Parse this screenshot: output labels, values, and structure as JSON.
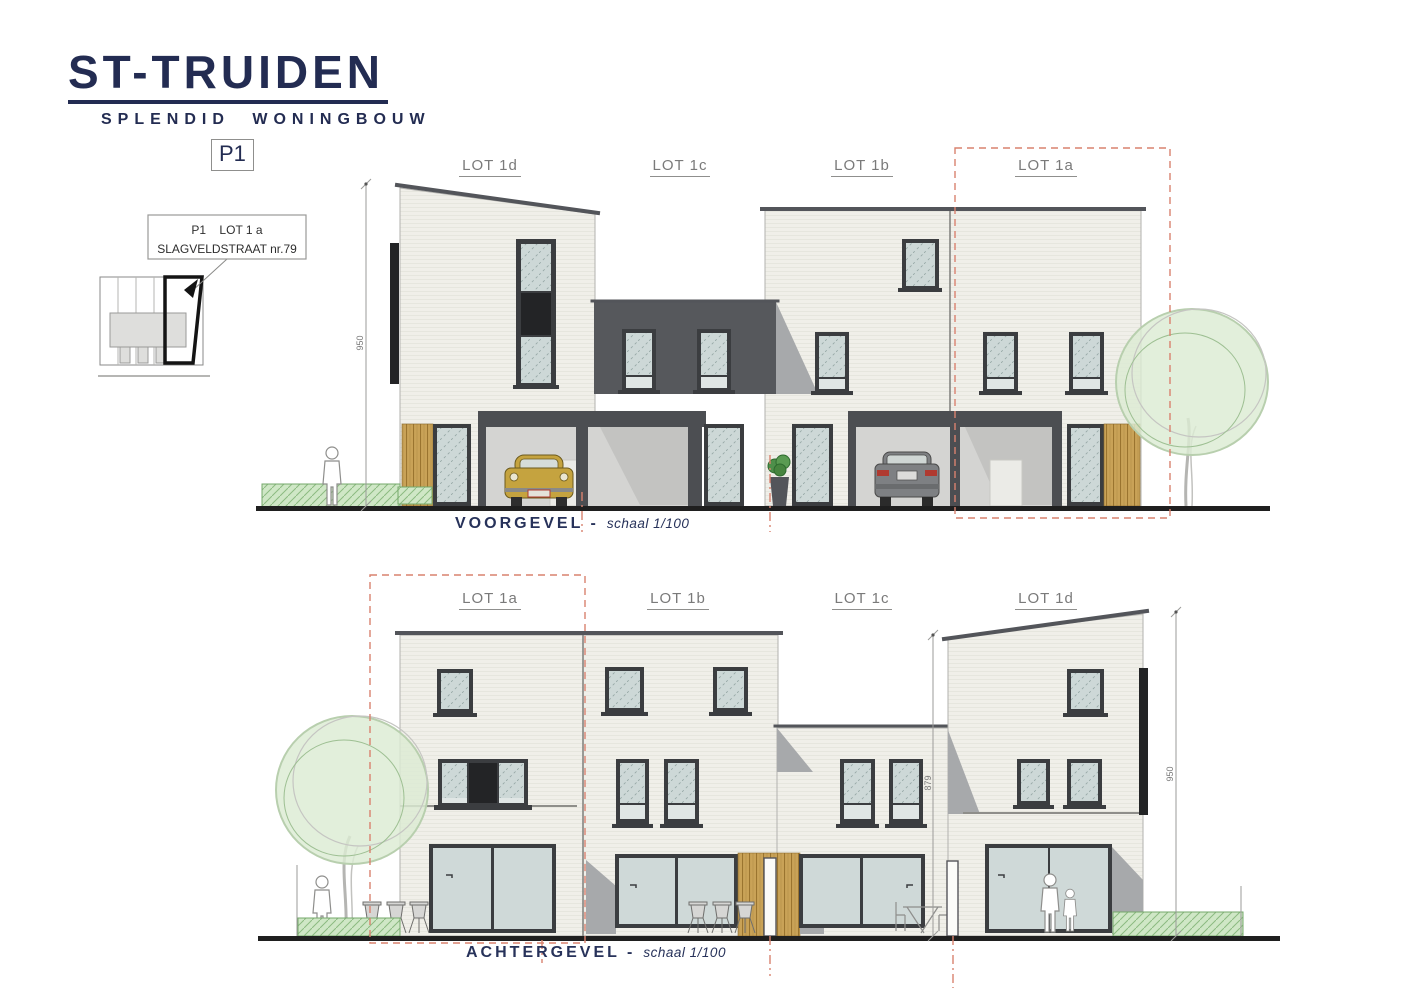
{
  "header": {
    "title": "ST-TRUIDEN",
    "subtitle": "SPLENDID WONINGBOUW",
    "sheet": "P1"
  },
  "site_plan": {
    "callout_line1": "P1    LOT 1 a",
    "callout_line2": "SLAGVELDSTRAAT nr.79"
  },
  "voorgevel": {
    "caption": "VOORGEVEL -",
    "scale": "schaal 1/100",
    "lots": [
      {
        "label": "LOT 1d"
      },
      {
        "label": "LOT 1c"
      },
      {
        "label": "LOT 1b"
      },
      {
        "label": "LOT 1a"
      }
    ],
    "dim_height": "950"
  },
  "achtergevel": {
    "caption": "ACHTERGEVEL -",
    "scale": "schaal 1/100",
    "lots": [
      {
        "label": "LOT 1a"
      },
      {
        "label": "LOT 1b"
      },
      {
        "label": "LOT 1c"
      },
      {
        "label": "LOT 1d"
      }
    ],
    "dim_mid": "879",
    "dim_right": "950"
  },
  "colors": {
    "navy": "#232c52",
    "red_boundary": "#d9826f",
    "facade": "#f0efe9",
    "dark_gray": "#56585c",
    "frame": "#3b3d40",
    "glass": "#cdd8d7",
    "wood": "#c9a257",
    "green": "#dcebd3",
    "hedge": "#cfe7c6"
  }
}
